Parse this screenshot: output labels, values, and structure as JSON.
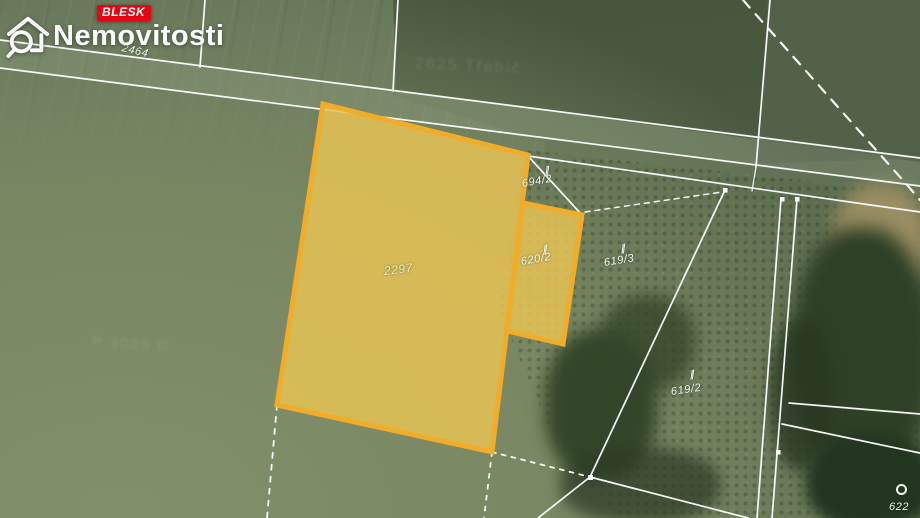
{
  "brand": {
    "badge": "BLESK",
    "badge_color": "#E40613",
    "name": "Nemovitosti"
  },
  "map": {
    "highlight_stroke": "#F1AD2A",
    "highlight_fill": "rgba(229,195,85,0.85)",
    "boundary_color": "#FFFFFF",
    "land_use_symbol": "∥",
    "labels": {
      "road": "2464",
      "main_parcel": "2297",
      "secondary_parcel": "620/2",
      "parcel_694_2": "694/2",
      "parcel_619_3": "619/3",
      "parcel_619_2": "619/2",
      "parcel_622": "622"
    },
    "faint_labels": {
      "top": "2625 Třebíč",
      "left": "P 3025 G"
    }
  }
}
